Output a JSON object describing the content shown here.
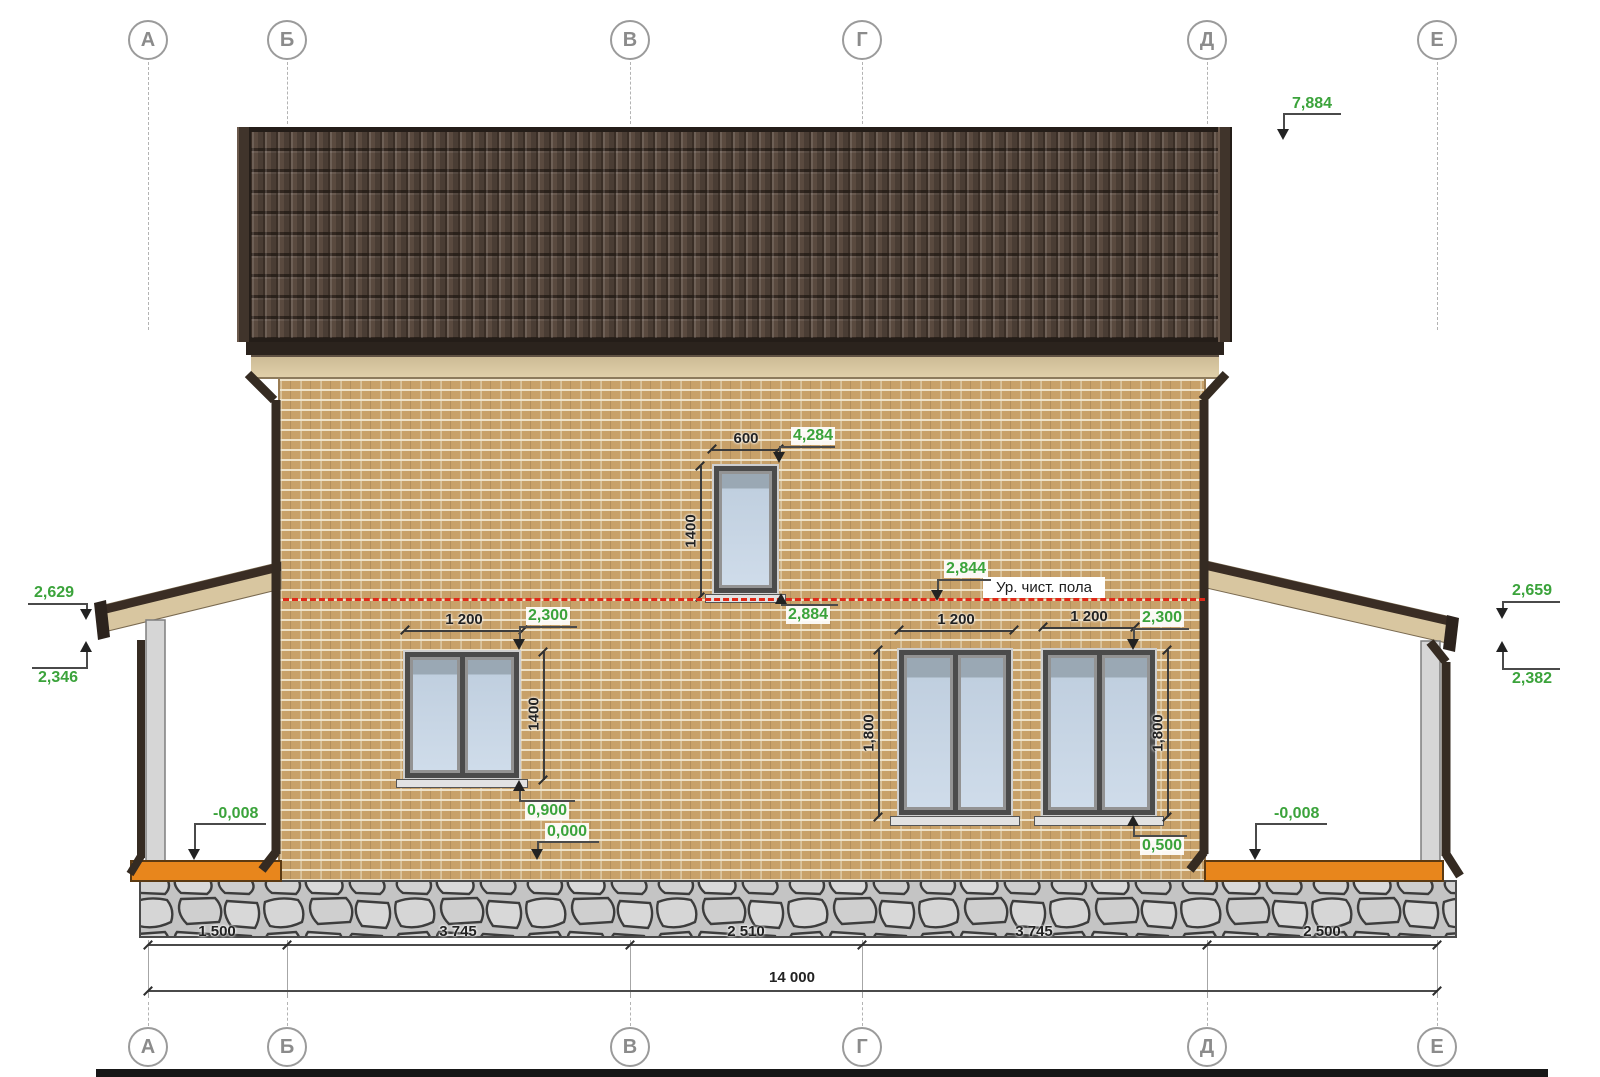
{
  "drawing": {
    "axes": [
      "А",
      "Б",
      "В",
      "Г",
      "Д",
      "Е"
    ],
    "floor_level_label": "Ур. чист. пола",
    "elevation_marks": {
      "roof_ridge": "7,884",
      "left_canopy_top": "2,629",
      "left_canopy_bottom": "2,346",
      "right_canopy_top": "2,659",
      "right_canopy_bottom": "2,382",
      "attic_window_head": "4,284",
      "second_floor": "2,844",
      "attic_window_sill": "2,884",
      "w1_head": "2,300",
      "w34_head": "2,300",
      "w1_sill": "0,900",
      "first_floor": "0,000",
      "w34_sill": "0,500",
      "left_porch_floor": "-0,008",
      "right_porch_floor": "-0,008"
    },
    "window_dims": {
      "attic_width": "600",
      "attic_height": "1400",
      "w1_width": "1 200",
      "w1_height": "1400",
      "w3_width": "1 200",
      "w3_height": "1,800",
      "w4_width": "1 200",
      "w4_height": "1,800"
    },
    "axis_dims": [
      "1 500",
      "3 745",
      "2 510",
      "3 745",
      "2 500"
    ],
    "total_dim": "14 000",
    "colors": {
      "green_label": "#3ba33b",
      "red_floor_line": "#e02818",
      "brick": "#c8a169",
      "roof": "#5a4a3f",
      "porch_floor": "#e8861c"
    }
  }
}
